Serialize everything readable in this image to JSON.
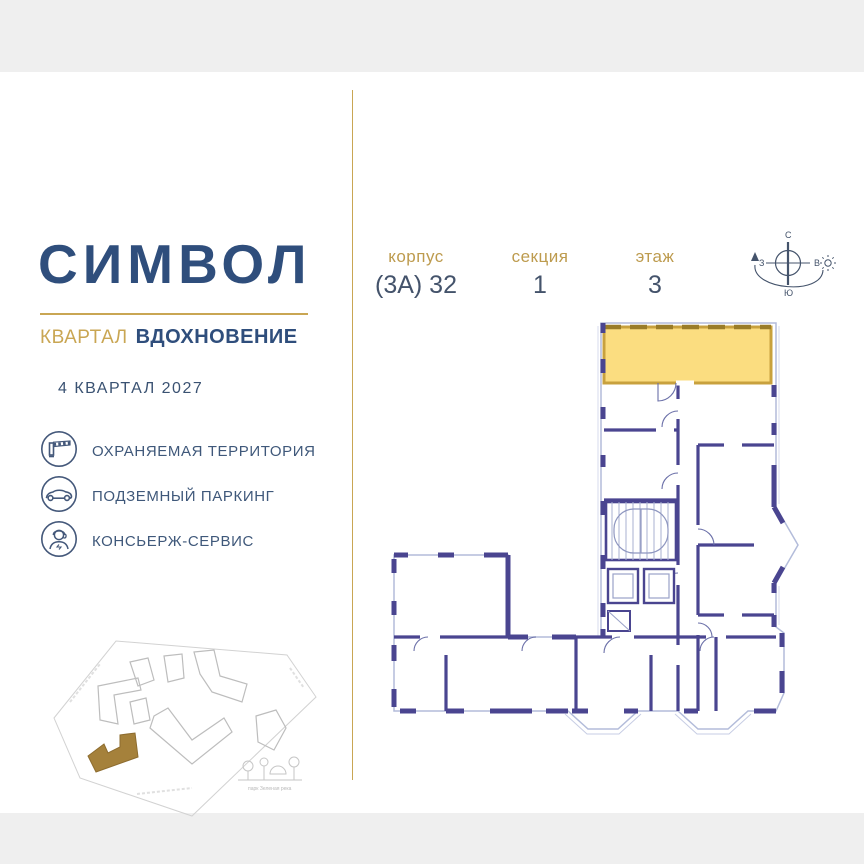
{
  "brand": {
    "name": "СИМВОЛ",
    "district_label": "КВАРТАЛ",
    "district_name": "ВДОХНОВЕНИЕ",
    "completion": "4 КВАРТАЛ 2027"
  },
  "specs": [
    {
      "label": "корпус",
      "value": "(3А) 32"
    },
    {
      "label": "секция",
      "value": "1"
    },
    {
      "label": "этаж",
      "value": "3"
    }
  ],
  "compass": {
    "north": "С",
    "south": "Ю",
    "west": "З",
    "east": "В"
  },
  "amenities": [
    {
      "icon": "barrier-icon",
      "label": "ОХРАНЯЕМАЯ ТЕРРИТОРИЯ"
    },
    {
      "icon": "car-icon",
      "label": "ПОДЗЕМНЫЙ ПАРКИНГ"
    },
    {
      "icon": "concierge-icon",
      "label": "КОНСЬЕРЖ-СЕРВИС"
    }
  ],
  "minimap": {
    "park_label": "парк Зеленая река"
  },
  "floorplan": {
    "highlighted_unit": "выделенная квартира"
  },
  "colors": {
    "brand_navy": "#2f4e7c",
    "gold": "#c9a653",
    "wall_purple": "#4a4590",
    "window_blue": "#b3bcda",
    "unit_fill": "#fbdd80",
    "unit_border": "#c8a13e",
    "band_gray": "#efefef"
  }
}
